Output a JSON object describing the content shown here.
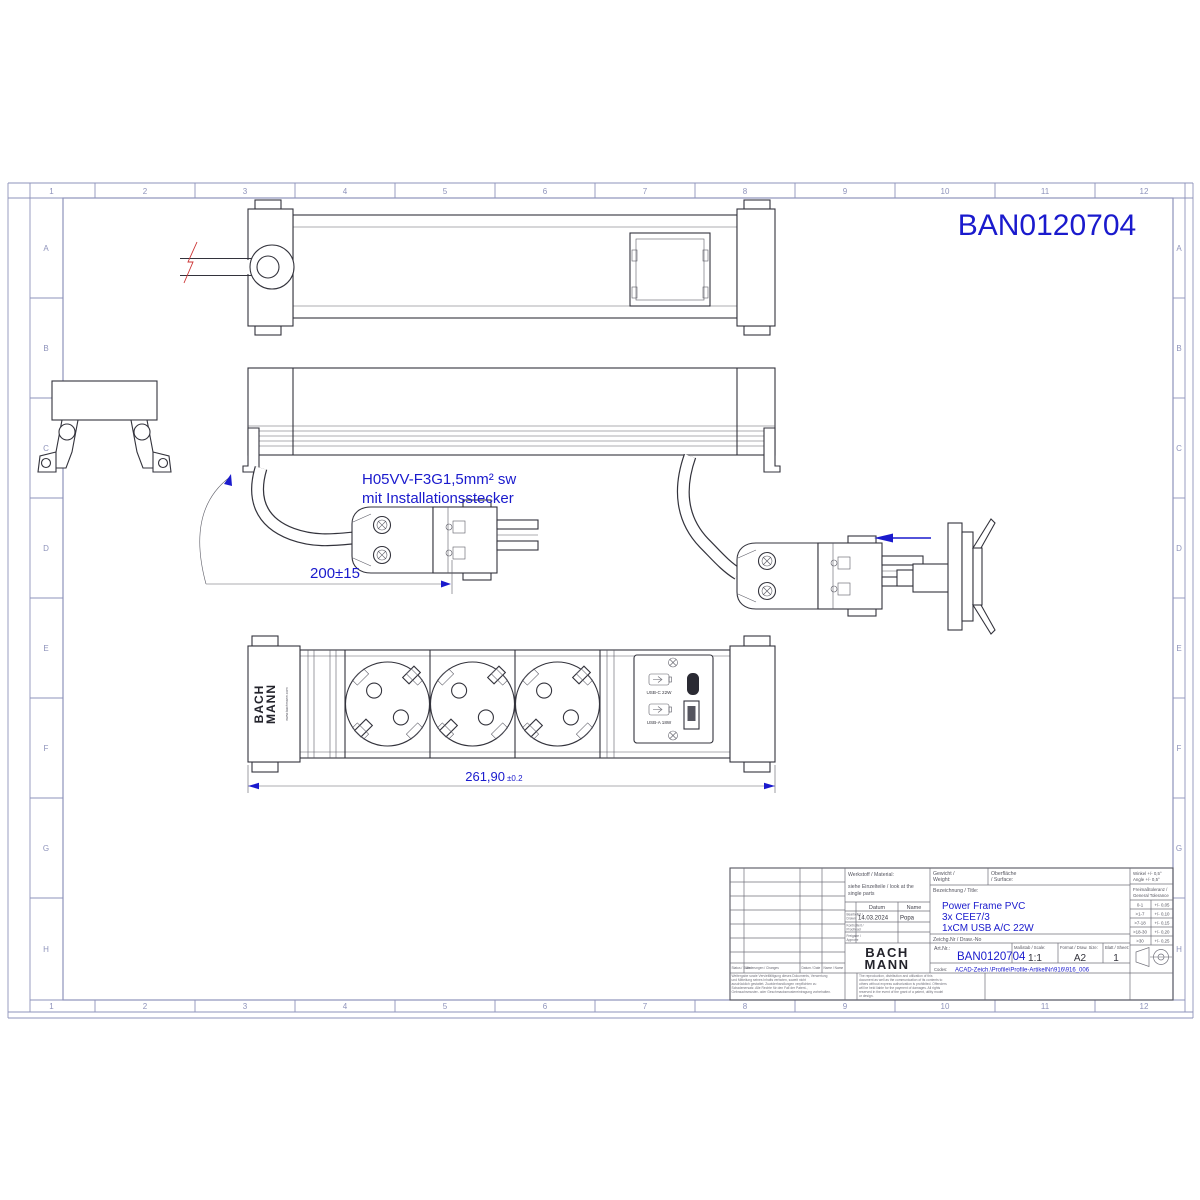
{
  "colors": {
    "accent_blue": "#1a1acd",
    "frame_lines": "#8e93bb",
    "drawing_lines": "#33333c",
    "break_mark_red": "#cc3333"
  },
  "grid": {
    "cols": [
      "1",
      "2",
      "3",
      "4",
      "5",
      "6",
      "7",
      "8",
      "9",
      "10",
      "11",
      "12"
    ],
    "rows": [
      "A",
      "B",
      "C",
      "D",
      "E",
      "F",
      "G",
      "H"
    ]
  },
  "annotations": {
    "part_number": "BAN0120704",
    "cable_spec_line1": "H05VV-F3G1,5mm² sw",
    "cable_spec_line2": "mit Installationsstecker",
    "cable_length_dim": "200±15",
    "strip_length_dim": "261,90",
    "strip_length_tol": "±0.2"
  },
  "front_view": {
    "logo_line1": "BACH",
    "logo_line2": "MANN",
    "logo_url": "www.bachmann.com",
    "usb_c_label": "USB-C 22W",
    "usb_a_label": "USB-A 18W"
  },
  "title_block": {
    "material_label": "Werkstoff / Material:",
    "material_value1": "siehe Einzelteile / look at the",
    "material_value2": "single parts",
    "weight_label1": "Gewicht /",
    "weight_label2": "Weight:",
    "surface_label1": "Oberfläche",
    "surface_label2": "/ Surface:",
    "designation_label": "Bezeichnung / Title:",
    "title_lines": [
      "Power Frame PVC",
      "3x CEE7/3",
      "1xCM USB A/C 22W"
    ],
    "drawno_label": "Zeichg.Nr / Draw.-No",
    "artnr_label": "Art.Nr.:",
    "artnr_value": "BAN0120704",
    "scale_label": "Maßstab / Scale:",
    "scale_value": "1:1",
    "format_label": "Format / Draw. Size:",
    "format_value": "A2",
    "sheet_label": "Blatt / Sheet:",
    "sheet_value": "1",
    "codes_label": "Codes:",
    "codes_value": "ACAD-Zeich.\\Profile\\Profile-ArtikelNr\\916\\916_006",
    "logo_line1": "BACH",
    "logo_line2": "MANN",
    "datum_header": "Datum",
    "name_header": "Name",
    "drawn_label1": "Bearbeitet /",
    "drawn_label2": "Drawn:",
    "drawn_date": "14.03.2024",
    "drawn_name": "Popa",
    "checked_label1": "Kontrolliert /",
    "checked_label2": "Proofread",
    "approved_label1": "Freigabe /",
    "approved_label2": "Approve",
    "status_label": "Status / State",
    "changes_label": "Änderungen / Changes",
    "date_label": "Datum / Date",
    "name_label": "Name / Name",
    "angle_tol1": "Winkel +/- 0,5°",
    "angle_tol2": "Angle +/- 0,5°",
    "gen_tol1": "Freimaßtoleranz /",
    "gen_tol2": "General Tolerance",
    "tol_rows": [
      [
        "0-1",
        "+/- 0,05"
      ],
      [
        ">1-7",
        "+/- 0,10"
      ],
      [
        ">7-18",
        "+/- 0,15"
      ],
      [
        ">18-30",
        "+/- 0,20"
      ],
      [
        ">30",
        "+/- 0,25"
      ]
    ],
    "legal_de": "Weitergabe sowie Vervielfältigung dieses Dokuments, Verwertung und Mitteilung seines Inhalts verboten, soweit nicht ausdrücklich gestattet. Zuwiderhandlungen verpflichten zu Schadenersatz. Alle Rechte für den Fall der Patent-, Gebrauchsmuster- oder Geschmacksmustereintragung vorbehalten.",
    "legal_en": "The reproduction, distribution and utilization of this document as well as the communication of its contents to others without express authorization is prohibited. Offenders will be held liable for the payment of damages. All rights reserved in the event of the grant of a patent, utility model or design."
  }
}
